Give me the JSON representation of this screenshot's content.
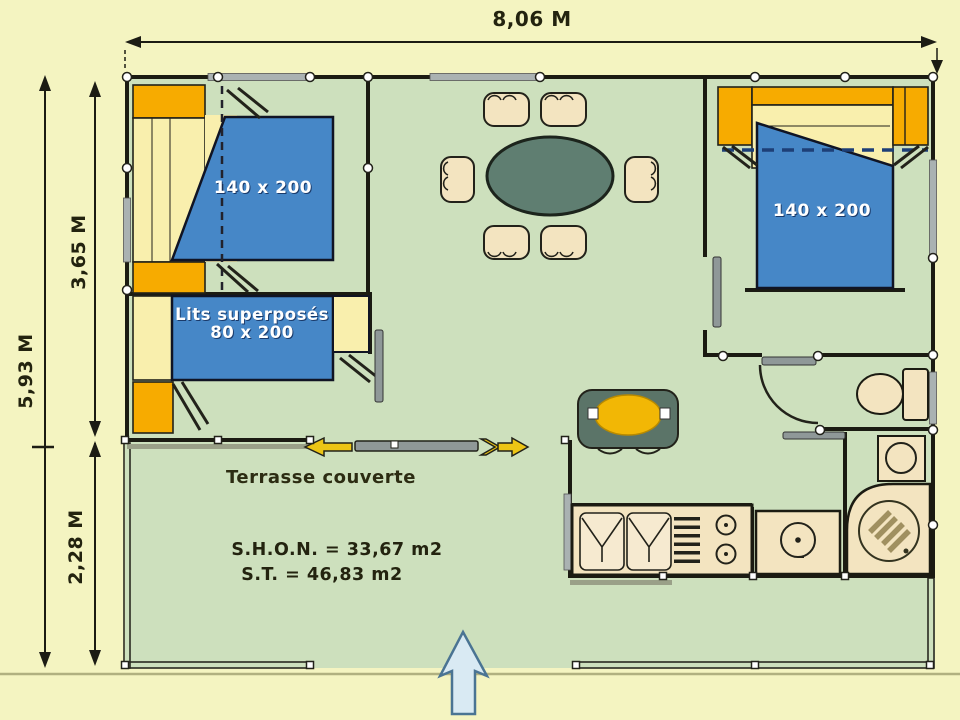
{
  "plan": {
    "title": "Chalet floor plan with covered terrace",
    "dimensions": {
      "total_width": "8,06 M",
      "total_depth": "5,93 M",
      "building_depth": "3,65 M",
      "terrace_depth": "2,28 M"
    },
    "labels": {
      "bedroom_left_bed": "140 x 200",
      "bunk_beds_line1": "Lits superposés",
      "bunk_beds_line2": "80 x 200",
      "bedroom_right_bed": "140 x 200",
      "terrace": "Terrasse couverte",
      "shon_area": "S.H.O.N. = 33,67 m2",
      "st_area": "S.T. = 46,83 m2"
    },
    "objects": [
      "double-bed",
      "bunk-bed",
      "wardrobes",
      "dining-table",
      "six-chairs",
      "small-table",
      "kitchen-sink",
      "drainer",
      "hob",
      "appliance",
      "shower",
      "washbasin",
      "toilet",
      "sliding-door",
      "door-leaves",
      "entrance-arrow",
      "terrace-railing"
    ],
    "colors": {
      "background": "#f4f4c1",
      "floor_green": "#cde0bd",
      "wall_black": "#1b1b12",
      "bed_blue": "#4687c7",
      "wardrobe_orange": "#f7ab00",
      "pillow_yellow": "#f9efad",
      "furniture_cream": "#f3e4c0",
      "table_green": "#5f7e71",
      "door_gray": "#8f9898",
      "window_gray": "#aab2b2",
      "slide_arrow_yellow": "#ecc515",
      "entry_arrow_blue": "#d9eaf3",
      "text_dark": "#23230f",
      "text_light": "#ffffff"
    }
  }
}
